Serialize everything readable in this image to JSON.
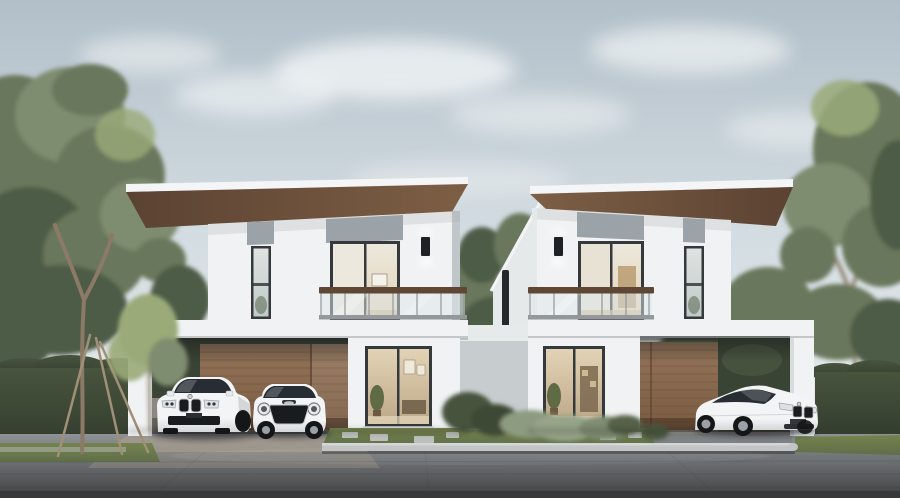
{
  "meta": {
    "alt": "Photorealistic exterior rendering: two mirrored modern two-storey white houses with wood-soffit flat roofs, glass balconies, carports with wood-slat walls, three white cars parked in front, trees and hedges under a pale sky"
  },
  "colors": {
    "sky_top": "#b2bfc9",
    "sky_mid": "#d4dde2",
    "sky_low": "#e9eded",
    "cloud": "#f4f7f8",
    "tree_dark": "#4e5b46",
    "tree_mid": "#69775c",
    "tree_soft": "#7e8c6f",
    "tree_light": "#9aaa78",
    "trunk": "#8b7a65",
    "stake": "#a09078",
    "hedge_top": "#48543e",
    "hedge_dark": "#323b2d",
    "hedge_carport": "#3a4434",
    "grass": "#5f6e49",
    "grass_light": "#75834f",
    "wall_white": "#f0f2f3",
    "wall_off": "#e6e9ea",
    "wall_shade": "#d9dcde",
    "panel_gray": "#9ba2a8",
    "fascia": "#f3f5f6",
    "soffit_light": "#7d5f45",
    "soffit_dark": "#5b4232",
    "wood_light": "#94755a",
    "wood_dark": "#7a5a40",
    "plank_line": "#66503c",
    "frame_dark": "#35393c",
    "glass_cool": "#dfe3e2",
    "glass_cool_low": "#c0cac6",
    "curtain": "#ece8dd",
    "glass_warm": "#e3d3b6",
    "glass_warm_low": "#bda887",
    "balc_glass": "#dde8eb",
    "rail_wood": "#5e4835",
    "rail_metal": "#94989b",
    "sconce": "#1f2225",
    "fence_light": "#e7eaeb",
    "fence_shade": "#c7ccce",
    "downpipe": "#26292b",
    "road_top": "#8f9395",
    "road_mid": "#6b6e70",
    "road_low": "#4b4d4f",
    "road_edge": "#37393b",
    "apron": "#a29a8e",
    "curb": "#c2c4c5",
    "stone": "#c6c8c8",
    "car_white": "#f3f4f5",
    "car_shade": "#d3d7d9",
    "car_glass": "#272d32",
    "tire": "#141617",
    "rim": "#9ba1a6",
    "grille": "#191c1e",
    "shadow": "#16181a",
    "carport_floor": "#8c8780"
  },
  "scene": {
    "houses": [
      {
        "id": "left",
        "storeys": 2,
        "balcony_side": "right",
        "carport_side": "left",
        "cars_parked": 2
      },
      {
        "id": "right",
        "storeys": 2,
        "balcony_side": "left",
        "carport_side": "right",
        "cars_parked": 1
      }
    ],
    "cars": [
      {
        "id": "suv",
        "style": "luxury SUV",
        "color": "white"
      },
      {
        "id": "mini",
        "style": "compact hatch",
        "color": "white"
      },
      {
        "id": "coupe",
        "style": "sports coupe",
        "color": "white"
      }
    ]
  }
}
